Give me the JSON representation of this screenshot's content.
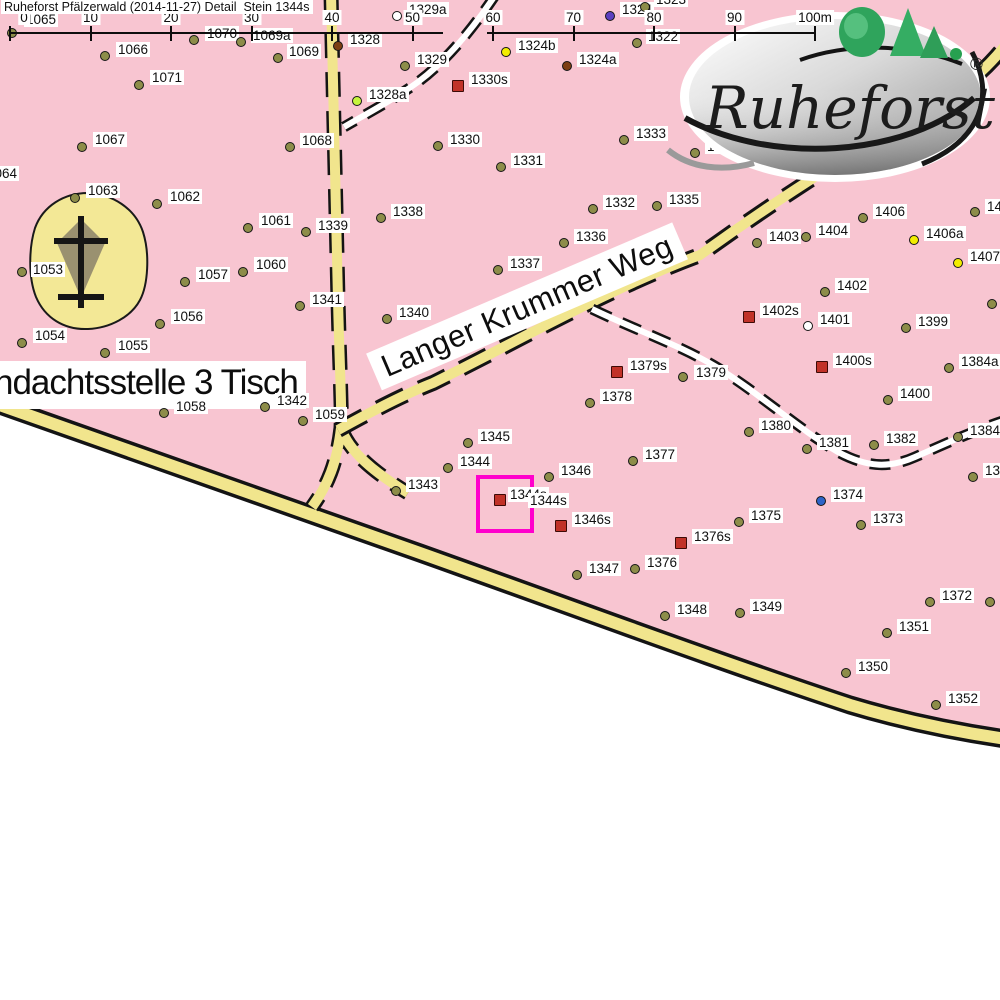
{
  "header": {
    "title": "Ruheforst Pfälzerwald (2014-11-27) Detail  Stein 1344s"
  },
  "logo": {
    "brand": "Ruheforst",
    "registered": "®"
  },
  "streets": {
    "langer_krummer_weg": "Langer Krummer Weg"
  },
  "labels": {
    "andachtsstelle": "ndachtsstelle 3 Tisch"
  },
  "scale": {
    "unit_labels": [
      "0",
      "10",
      "20",
      "30",
      "40",
      "50",
      "60",
      "70",
      "80",
      "90",
      "100m"
    ],
    "x0": 10,
    "spacing": 80.5
  },
  "highlight": {
    "stone_label": "1344s",
    "color": "#ff00cc",
    "box": {
      "x": 476,
      "y": 475,
      "w": 50,
      "h": 50
    }
  },
  "colors": {
    "background_pink": "#f8c5d1",
    "road_yellow": "#f1e58d",
    "tree_marker": "#8d8d49",
    "stone_marker": "#c13228",
    "highlight_magenta": "#ff00cc",
    "blue_marker": "#2e64c8",
    "purple_marker": "#5b3fc0",
    "yellow_marker": "#f2ed00",
    "lime_marker": "#c6f53c",
    "brown_marker": "#7d3f14",
    "white_marker": "#ffffff"
  },
  "points": [
    {
      "id": "1065",
      "x": 12,
      "y": 33,
      "t": "tree",
      "lx": 24,
      "ly": 12
    },
    {
      "id": "1066",
      "x": 105,
      "y": 56,
      "t": "tree",
      "lx": 116,
      "ly": 42
    },
    {
      "id": "1070",
      "x": 194,
      "y": 40,
      "t": "tree",
      "lx": 205,
      "ly": 26
    },
    {
      "id": "1069a",
      "x": 241,
      "y": 42,
      "t": "tree",
      "lx": 251,
      "ly": 28
    },
    {
      "id": "1071",
      "x": 139,
      "y": 85,
      "t": "tree",
      "lx": 150,
      "ly": 70
    },
    {
      "id": "1067",
      "x": 82,
      "y": 147,
      "t": "tree",
      "lx": 93,
      "ly": 132
    },
    {
      "id": "1063",
      "x": 75,
      "y": 198,
      "t": "tree",
      "lx": 86,
      "ly": 183
    },
    {
      "id": "1062",
      "x": 157,
      "y": 204,
      "t": "tree",
      "lx": 168,
      "ly": 189
    },
    {
      "id": "1061",
      "x": 248,
      "y": 228,
      "t": "tree",
      "lx": 259,
      "ly": 213
    },
    {
      "id": "1060",
      "x": 243,
      "y": 272,
      "t": "tree",
      "lx": 254,
      "ly": 257
    },
    {
      "id": "1057",
      "x": 185,
      "y": 282,
      "t": "tree",
      "lx": 196,
      "ly": 267
    },
    {
      "id": "1056",
      "x": 160,
      "y": 324,
      "t": "tree",
      "lx": 171,
      "ly": 309
    },
    {
      "id": "1053",
      "x": 22,
      "y": 272,
      "t": "tree",
      "lx": 31,
      "ly": 262
    },
    {
      "id": "1054",
      "x": 22,
      "y": 343,
      "t": "tree",
      "lx": 33,
      "ly": 328
    },
    {
      "id": "1055",
      "x": 105,
      "y": 353,
      "t": "tree",
      "lx": 116,
      "ly": 338
    },
    {
      "id": "1064",
      "x": -28,
      "y": 178,
      "t": "tree",
      "lx": -15,
      "ly": 166
    },
    {
      "id": "1058",
      "x": 164,
      "y": 413,
      "t": "tree",
      "lx": 174,
      "ly": 399
    },
    {
      "id": "1342",
      "x": 265,
      "y": 407,
      "t": "tree",
      "lx": 275,
      "ly": 393
    },
    {
      "id": "1059",
      "x": 303,
      "y": 421,
      "t": "tree",
      "lx": 313,
      "ly": 407
    },
    {
      "id": "1341",
      "x": 300,
      "y": 306,
      "t": "tree",
      "lx": 310,
      "ly": 292
    },
    {
      "id": "1339",
      "x": 306,
      "y": 232,
      "t": "tree",
      "lx": 316,
      "ly": 218
    },
    {
      "id": "1068",
      "x": 290,
      "y": 147,
      "t": "tree",
      "lx": 300,
      "ly": 133
    },
    {
      "id": "1069",
      "x": 278,
      "y": 58,
      "t": "tree",
      "lx": 287,
      "ly": 44
    },
    {
      "id": "1328",
      "x": 338,
      "y": 46,
      "t": "brown",
      "lx": 348,
      "ly": 32
    },
    {
      "id": "1329",
      "x": 405,
      "y": 66,
      "t": "tree",
      "lx": 415,
      "ly": 52
    },
    {
      "id": "1329a",
      "x": 397,
      "y": 16,
      "t": "white",
      "lx": 407,
      "ly": 2
    },
    {
      "id": "1328a",
      "x": 357,
      "y": 101,
      "t": "lime",
      "lx": 367,
      "ly": 87
    },
    {
      "id": "1330s",
      "x": 458,
      "y": 86,
      "t": "stone",
      "lx": 469,
      "ly": 72
    },
    {
      "id": "1324",
      "x": 610,
      "y": 16,
      "t": "purple",
      "lx": 620,
      "ly": 2
    },
    {
      "id": "1323",
      "x": 645,
      "y": 7,
      "t": "tree",
      "lx": 654,
      "ly": -8
    },
    {
      "id": "1322",
      "x": 637,
      "y": 43,
      "t": "tree",
      "lx": 646,
      "ly": 29
    },
    {
      "id": "1324b",
      "x": 506,
      "y": 52,
      "t": "yellow",
      "lx": 516,
      "ly": 38
    },
    {
      "id": "1324a",
      "x": 567,
      "y": 66,
      "t": "brown",
      "lx": 577,
      "ly": 52
    },
    {
      "id": "1330",
      "x": 438,
      "y": 146,
      "t": "tree",
      "lx": 448,
      "ly": 132
    },
    {
      "id": "1331",
      "x": 501,
      "y": 167,
      "t": "tree",
      "lx": 511,
      "ly": 153
    },
    {
      "id": "1333",
      "x": 624,
      "y": 140,
      "t": "tree",
      "lx": 634,
      "ly": 126
    },
    {
      "id": "1334",
      "x": 695,
      "y": 153,
      "t": "tree",
      "lx": 705,
      "ly": 139
    },
    {
      "id": "1332",
      "x": 593,
      "y": 209,
      "t": "tree",
      "lx": 603,
      "ly": 195
    },
    {
      "id": "1335",
      "x": 657,
      "y": 206,
      "t": "tree",
      "lx": 667,
      "ly": 192
    },
    {
      "id": "1336",
      "x": 564,
      "y": 243,
      "t": "tree",
      "lx": 574,
      "ly": 229
    },
    {
      "id": "1337",
      "x": 498,
      "y": 270,
      "t": "tree",
      "lx": 508,
      "ly": 256
    },
    {
      "id": "1338",
      "x": 381,
      "y": 218,
      "t": "tree",
      "lx": 391,
      "ly": 204
    },
    {
      "id": "1340",
      "x": 387,
      "y": 319,
      "t": "tree",
      "lx": 397,
      "ly": 305
    },
    {
      "id": "1343",
      "x": 396,
      "y": 491,
      "t": "tree",
      "lx": 406,
      "ly": 477
    },
    {
      "id": "1344",
      "x": 448,
      "y": 468,
      "t": "tree",
      "lx": 458,
      "ly": 454
    },
    {
      "id": "1345",
      "x": 468,
      "y": 443,
      "t": "tree",
      "lx": 478,
      "ly": 429
    },
    {
      "id": "1346",
      "x": 549,
      "y": 477,
      "t": "tree",
      "lx": 559,
      "ly": 463
    },
    {
      "id": "",
      "x": 500,
      "y": 500,
      "t": "stone"
    },
    {
      "id": "1346s",
      "x": 561,
      "y": 526,
      "t": "stone",
      "lx": 572,
      "ly": 512
    },
    {
      "id": "1347",
      "x": 577,
      "y": 575,
      "t": "tree",
      "lx": 587,
      "ly": 561
    },
    {
      "id": "1348",
      "x": 665,
      "y": 616,
      "t": "tree",
      "lx": 675,
      "ly": 602
    },
    {
      "id": "1349",
      "x": 740,
      "y": 613,
      "t": "tree",
      "lx": 750,
      "ly": 599
    },
    {
      "id": "1350",
      "x": 846,
      "y": 673,
      "t": "tree",
      "lx": 856,
      "ly": 659
    },
    {
      "id": "1351",
      "x": 887,
      "y": 633,
      "t": "tree",
      "lx": 897,
      "ly": 619
    },
    {
      "id": "1352",
      "x": 936,
      "y": 705,
      "t": "tree",
      "lx": 946,
      "ly": 691
    },
    {
      "id": "1372",
      "x": 930,
      "y": 602,
      "t": "tree",
      "lx": 940,
      "ly": 588
    },
    {
      "id": "1373",
      "x": 861,
      "y": 525,
      "t": "tree",
      "lx": 871,
      "ly": 511
    },
    {
      "id": "1374",
      "x": 821,
      "y": 501,
      "t": "blue",
      "lx": 831,
      "ly": 487
    },
    {
      "id": "1375",
      "x": 739,
      "y": 522,
      "t": "tree",
      "lx": 749,
      "ly": 508
    },
    {
      "id": "1376",
      "x": 635,
      "y": 569,
      "t": "tree",
      "lx": 645,
      "ly": 555
    },
    {
      "id": "1376s",
      "x": 681,
      "y": 543,
      "t": "stone",
      "lx": 692,
      "ly": 529
    },
    {
      "id": "1377",
      "x": 633,
      "y": 461,
      "t": "tree",
      "lx": 643,
      "ly": 447
    },
    {
      "id": "1378",
      "x": 590,
      "y": 403,
      "t": "tree",
      "lx": 600,
      "ly": 389
    },
    {
      "id": "1379",
      "x": 683,
      "y": 377,
      "t": "tree",
      "lx": 694,
      "ly": 365
    },
    {
      "id": "1379s",
      "x": 617,
      "y": 372,
      "t": "stone",
      "lx": 628,
      "ly": 358
    },
    {
      "id": "1380",
      "x": 749,
      "y": 432,
      "t": "tree",
      "lx": 759,
      "ly": 418
    },
    {
      "id": "1381",
      "x": 807,
      "y": 449,
      "t": "tree",
      "lx": 817,
      "ly": 435
    },
    {
      "id": "1382",
      "x": 874,
      "y": 445,
      "t": "tree",
      "lx": 884,
      "ly": 431
    },
    {
      "id": "1384",
      "x": 958,
      "y": 437,
      "t": "tree",
      "lx": 968,
      "ly": 423
    },
    {
      "id": "1384a",
      "x": 949,
      "y": 368,
      "t": "tree",
      "lx": 959,
      "ly": 354
    },
    {
      "id": "1399",
      "x": 906,
      "y": 328,
      "t": "tree",
      "lx": 916,
      "ly": 314
    },
    {
      "id": "1400",
      "x": 888,
      "y": 400,
      "t": "tree",
      "lx": 898,
      "ly": 386
    },
    {
      "id": "1400s",
      "x": 822,
      "y": 367,
      "t": "stone",
      "lx": 833,
      "ly": 353
    },
    {
      "id": "1401",
      "x": 808,
      "y": 326,
      "t": "white",
      "lx": 818,
      "ly": 312
    },
    {
      "id": "1402",
      "x": 825,
      "y": 292,
      "t": "tree",
      "lx": 835,
      "ly": 278
    },
    {
      "id": "1402s",
      "x": 749,
      "y": 317,
      "t": "stone",
      "lx": 760,
      "ly": 303
    },
    {
      "id": "1403",
      "x": 757,
      "y": 243,
      "t": "tree",
      "lx": 767,
      "ly": 229
    },
    {
      "id": "1404",
      "x": 806,
      "y": 237,
      "t": "tree",
      "lx": 816,
      "ly": 223
    },
    {
      "id": "1406",
      "x": 863,
      "y": 218,
      "t": "tree",
      "lx": 873,
      "ly": 204
    },
    {
      "id": "1406a",
      "x": 914,
      "y": 240,
      "t": "yellow",
      "lx": 924,
      "ly": 226
    },
    {
      "id": "1407a",
      "x": 958,
      "y": 263,
      "t": "yellow",
      "lx": 968,
      "ly": 249
    },
    {
      "id": "140",
      "x": 975,
      "y": 212,
      "t": "tree",
      "lx": 985,
      "ly": 199
    },
    {
      "id": "138",
      "x": 973,
      "y": 477,
      "t": "tree",
      "lx": 983,
      "ly": 463
    },
    {
      "id": "",
      "x": 992,
      "y": 304,
      "t": "tree"
    },
    {
      "id": "",
      "x": 990,
      "y": 602,
      "t": "tree"
    }
  ]
}
